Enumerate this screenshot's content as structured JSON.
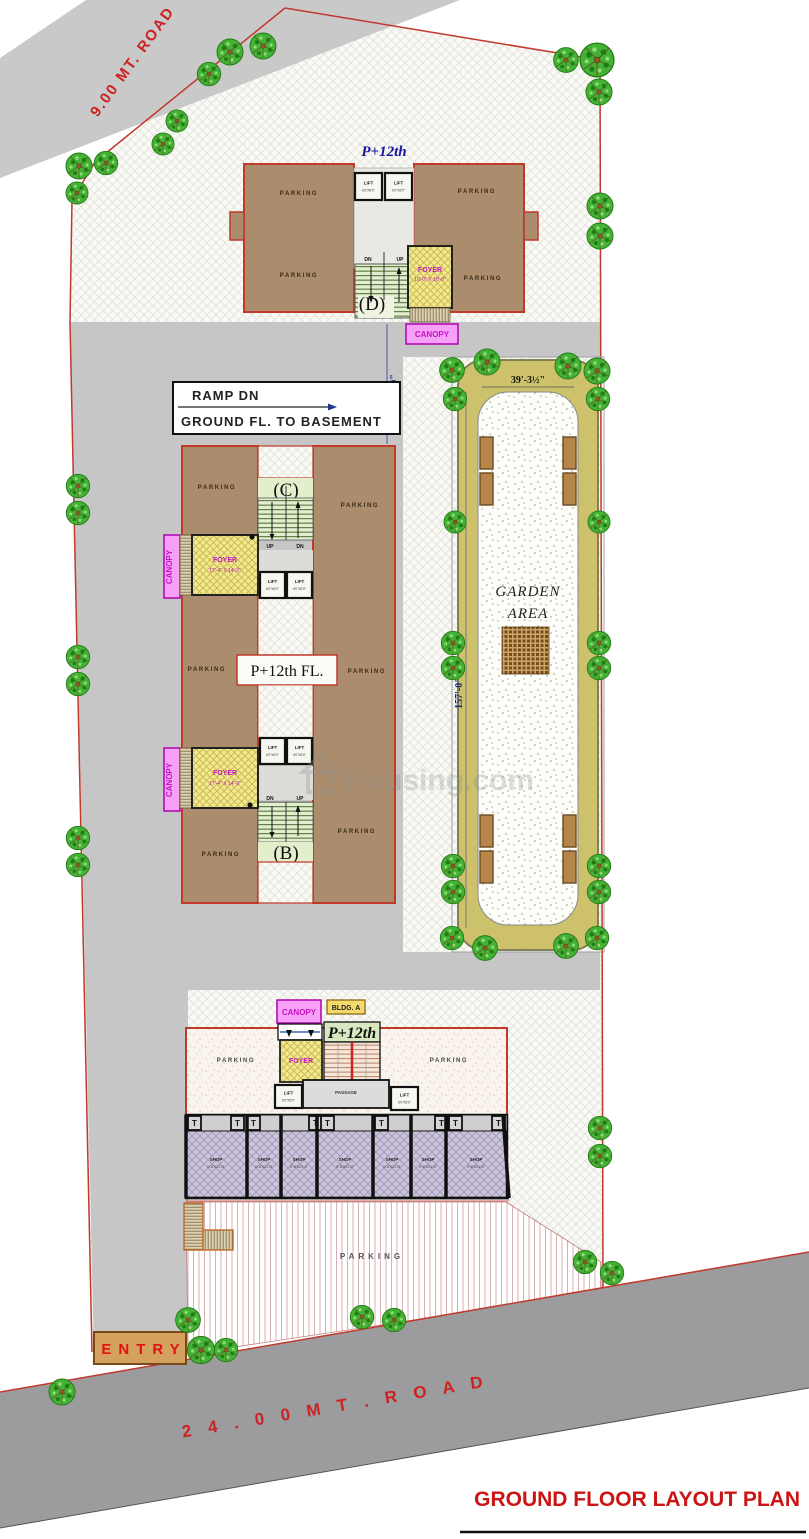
{
  "title": "GROUND FLOOR LAYOUT PLAN",
  "watermark": "Housing.com",
  "roads": {
    "top_road": "9.00 MT. ROAD",
    "bottom_road": "2 4 . 0 0   M T .   R O A D",
    "entry": "ENTRY"
  },
  "labels": {
    "parking": "PARKING",
    "lift": "LIFT",
    "lift_size": "6'0\"X6'0\"",
    "foyer": "FOYER",
    "canopy": "CANOPY",
    "up": "UP",
    "dn": "DN",
    "toilet": "T",
    "shop": "SHOP",
    "shop_size": "9'-6\"X21'-0\"",
    "passage": "PASSAGE"
  },
  "ramp": {
    "line1": "RAMP DN",
    "line2": "GROUND FL. TO BASEMENT"
  },
  "dimensions": {
    "ramp_width": "29'-10\"",
    "garden_width": "39'-3½\"",
    "garden_length": "157'-0\""
  },
  "garden": {
    "line1": "GARDEN",
    "line2": "AREA"
  },
  "building_d": {
    "floors": "P+12th",
    "core": "(D)",
    "foyer_size": "10'-0\" X 18'-0\""
  },
  "building_bc": {
    "floors": "P+12th FL.",
    "core_c": "(C)",
    "core_b": "(B)",
    "foyer_size": "17'-4\" X 14'-3\""
  },
  "building_a": {
    "name": "BLDG. A",
    "floors": "P+12th"
  }
}
